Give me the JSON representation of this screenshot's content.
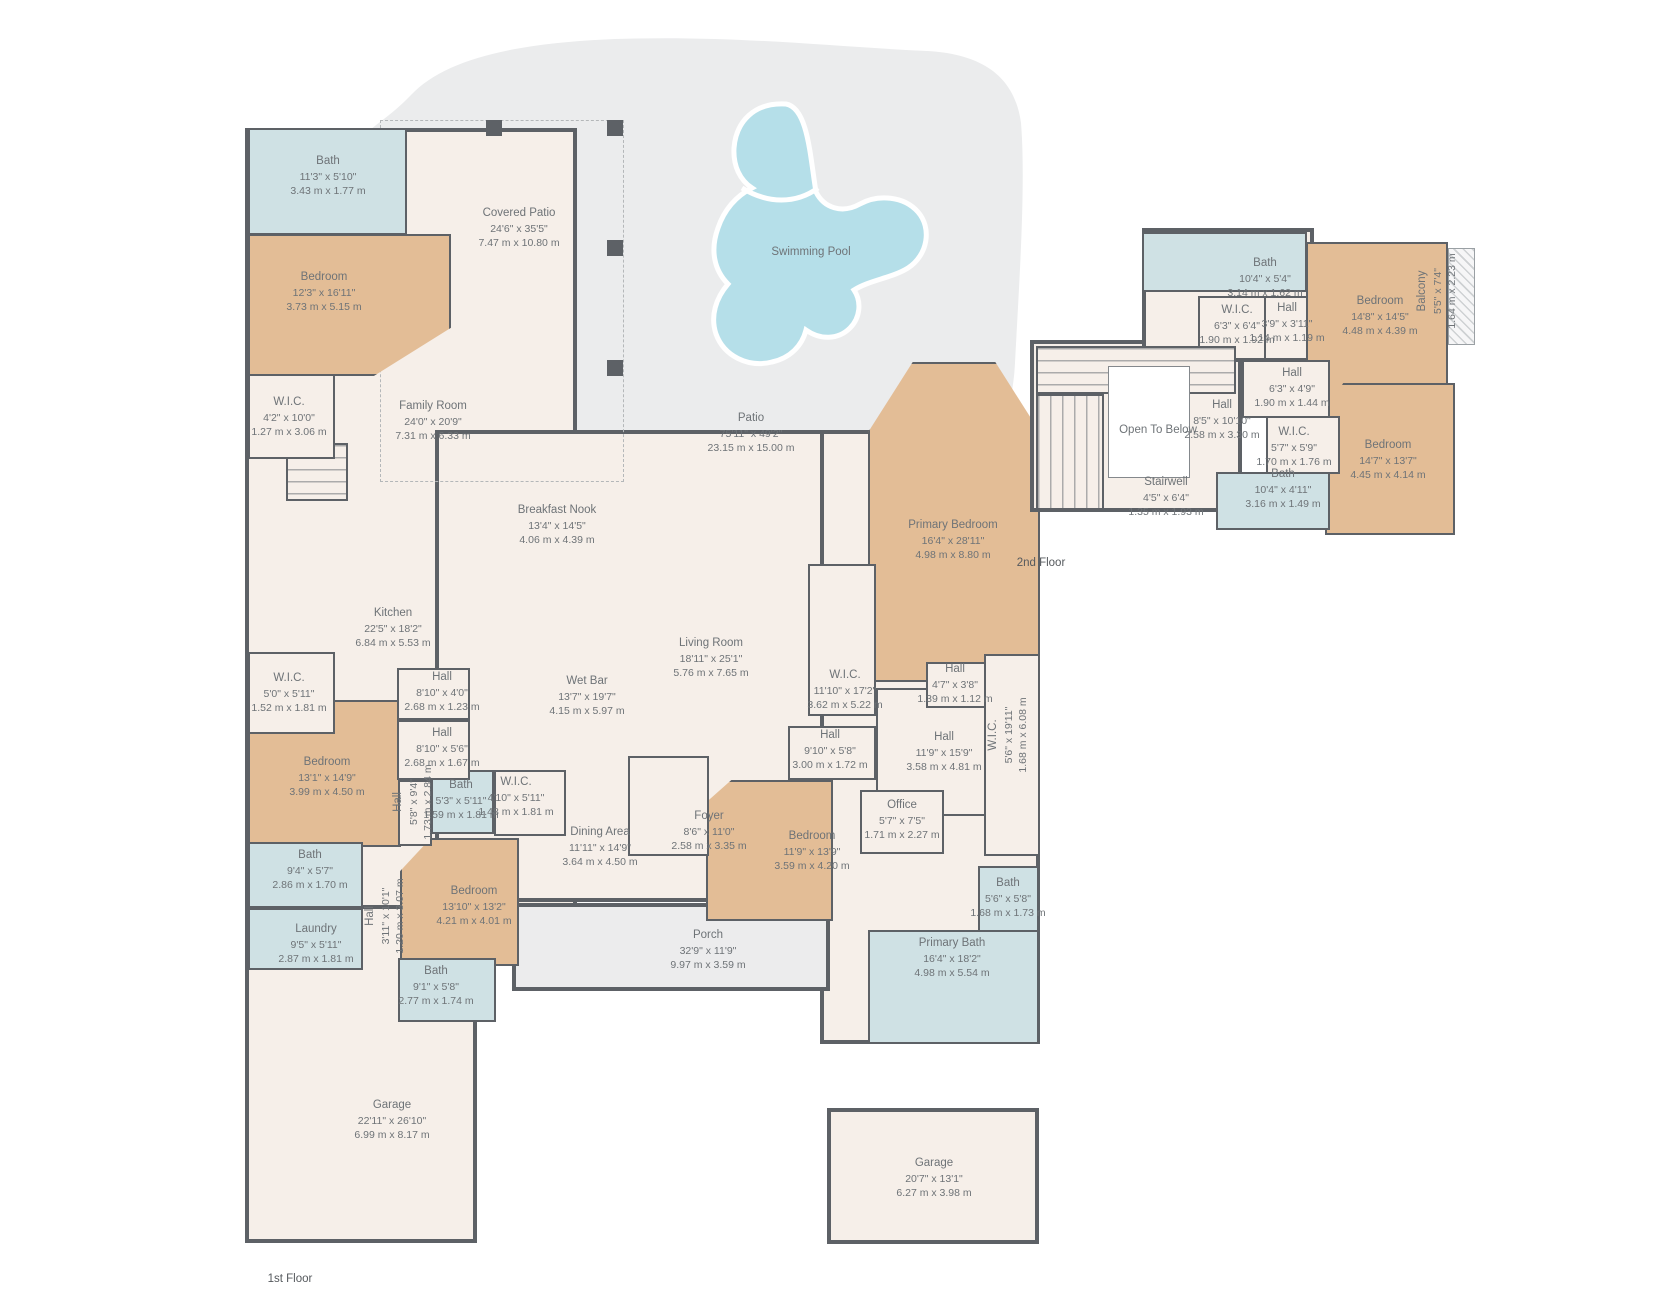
{
  "colors": {
    "wall": "#5d6166",
    "floor": "#f6efe9",
    "bedroom": "#e3bd96",
    "bath": "#cfe1e4",
    "outdoor": "#ebeced",
    "porch": "#ececed",
    "pool": "#b5dfe9",
    "text": "#6e7377",
    "white": "#ffffff"
  },
  "outdoor": {
    "patio_shape": "patio-area",
    "pool_shape": "swimming-pool"
  },
  "floors": [
    {
      "name": "1st Floor",
      "caption_x": 290,
      "caption_y": 1279,
      "blocks": [
        {
          "name": "left-wing",
          "cls": "outer",
          "fill": "floor",
          "x": 245,
          "y": 128,
          "w": 332,
          "h": 812
        },
        {
          "name": "center-wing",
          "cls": "outer",
          "fill": "floor",
          "x": 435,
          "y": 430,
          "w": 392,
          "h": 472
        },
        {
          "name": "right-wing",
          "cls": "outer",
          "fill": "floor",
          "x": 820,
          "y": 430,
          "w": 220,
          "h": 614
        },
        {
          "name": "garage-block",
          "cls": "outer",
          "fill": "floor",
          "x": 245,
          "y": 905,
          "w": 232,
          "h": 338
        },
        {
          "name": "porch",
          "cls": "outer",
          "fill": "porch",
          "x": 512,
          "y": 903,
          "w": 318,
          "h": 88
        },
        {
          "name": "garage-2",
          "cls": "outer",
          "fill": "floor",
          "x": 827,
          "y": 1108,
          "w": 212,
          "h": 136
        },
        {
          "name": "covered-patio-boundary",
          "cls": "dash",
          "x": 380,
          "y": 120,
          "w": 244,
          "h": 362
        },
        {
          "name": "column",
          "cls": "col",
          "fill": "wall",
          "x": 486,
          "y": 120,
          "w": 16,
          "h": 16
        },
        {
          "name": "column",
          "cls": "col",
          "fill": "wall",
          "x": 607,
          "y": 120,
          "w": 16,
          "h": 16
        },
        {
          "name": "column",
          "cls": "col",
          "fill": "wall",
          "x": 607,
          "y": 240,
          "w": 16,
          "h": 16
        },
        {
          "name": "column",
          "cls": "col",
          "fill": "wall",
          "x": 607,
          "y": 360,
          "w": 16,
          "h": 16
        },
        {
          "name": "stairs",
          "cls": "stairs-v",
          "fill": "floor",
          "x": 286,
          "y": 443,
          "w": 62,
          "h": 58
        },
        {
          "name": "bedroom",
          "fill": "bedroom",
          "x": 248,
          "y": 234,
          "w": 203,
          "h": 142,
          "clip": "polygon(0 0,100% 0,100% 66%,62% 100%,0 100%)"
        },
        {
          "name": "bedroom",
          "fill": "bedroom",
          "x": 248,
          "y": 700,
          "w": 153,
          "h": 147
        },
        {
          "name": "bedroom",
          "fill": "bedroom",
          "x": 400,
          "y": 838,
          "w": 119,
          "h": 128,
          "clip": "polygon(26% 0,100% 0,100% 100%,0 100%,0 26%)"
        },
        {
          "name": "bedroom",
          "fill": "bedroom",
          "x": 706,
          "y": 780,
          "w": 127,
          "h": 141,
          "clip": "polygon(20% 0,100% 0,100% 100%,0 100%,0 16%)"
        },
        {
          "name": "primary-bedroom",
          "fill": "bedroom",
          "x": 868,
          "y": 362,
          "w": 172,
          "h": 320,
          "clip": "polygon(0 22%,26% 0,74% 0,100% 22%,100% 100%,0 100%)"
        },
        {
          "name": "bath",
          "fill": "bath",
          "x": 248,
          "y": 128,
          "w": 159,
          "h": 107
        },
        {
          "name": "bath",
          "fill": "bath",
          "x": 431,
          "y": 770,
          "w": 63,
          "h": 64
        },
        {
          "name": "bath",
          "fill": "bath",
          "x": 248,
          "y": 842,
          "w": 115,
          "h": 66
        },
        {
          "name": "laundry",
          "fill": "bath",
          "x": 248,
          "y": 908,
          "w": 115,
          "h": 62
        },
        {
          "name": "bath",
          "fill": "bath",
          "x": 398,
          "y": 958,
          "w": 98,
          "h": 64
        },
        {
          "name": "bath",
          "fill": "bath",
          "x": 978,
          "y": 866,
          "w": 61,
          "h": 66
        },
        {
          "name": "primary-bath",
          "fill": "bath",
          "x": 868,
          "y": 930,
          "w": 171,
          "h": 114
        },
        {
          "name": "wic",
          "fill": "floor",
          "x": 248,
          "y": 374,
          "w": 87,
          "h": 85
        },
        {
          "name": "wic",
          "fill": "floor",
          "x": 248,
          "y": 652,
          "w": 87,
          "h": 82
        },
        {
          "name": "hall",
          "fill": "floor",
          "x": 397,
          "y": 668,
          "w": 73,
          "h": 52
        },
        {
          "name": "hall",
          "fill": "floor",
          "x": 397,
          "y": 720,
          "w": 73,
          "h": 60
        },
        {
          "name": "hall",
          "fill": "floor",
          "x": 398,
          "y": 780,
          "w": 34,
          "h": 66
        },
        {
          "name": "wic",
          "fill": "floor",
          "x": 494,
          "y": 770,
          "w": 72,
          "h": 66
        },
        {
          "name": "foyer",
          "fill": "floor",
          "x": 628,
          "y": 756,
          "w": 81,
          "h": 100
        },
        {
          "name": "hall",
          "fill": "floor",
          "x": 788,
          "y": 726,
          "w": 88,
          "h": 54
        },
        {
          "name": "hall",
          "fill": "floor",
          "x": 876,
          "y": 688,
          "w": 112,
          "h": 128
        },
        {
          "name": "office",
          "fill": "floor",
          "x": 860,
          "y": 790,
          "w": 84,
          "h": 64
        },
        {
          "name": "wic",
          "fill": "floor",
          "x": 808,
          "y": 564,
          "w": 68,
          "h": 152
        },
        {
          "name": "hall",
          "fill": "floor",
          "x": 926,
          "y": 662,
          "w": 60,
          "h": 46
        },
        {
          "name": "wic",
          "fill": "floor",
          "x": 984,
          "y": 654,
          "w": 56,
          "h": 202
        }
      ],
      "labels": [
        {
          "name": "Bath",
          "ft": "11'3\" x 5'10\"",
          "m": "3.43 m x 1.77 m",
          "x": 328,
          "y": 176
        },
        {
          "name": "Bedroom",
          "ft": "12'3\" x 16'11\"",
          "m": "3.73 m x 5.15 m",
          "x": 324,
          "y": 292
        },
        {
          "name": "Covered Patio",
          "ft": "24'6\" x 35'5\"",
          "m": "7.47 m x 10.80 m",
          "x": 519,
          "y": 228
        },
        {
          "name": "Swimming Pool",
          "ft": "",
          "m": "",
          "x": 811,
          "y": 253
        },
        {
          "name": "Patio",
          "ft": "75'11\" x 49'2\"",
          "m": "23.15 m x 15.00 m",
          "x": 751,
          "y": 433
        },
        {
          "name": "W.I.C.",
          "ft": "4'2\" x 10'0\"",
          "m": "1.27 m x 3.06 m",
          "x": 289,
          "y": 417
        },
        {
          "name": "Family Room",
          "ft": "24'0\" x 20'9\"",
          "m": "7.31 m x 6.33 m",
          "x": 433,
          "y": 421
        },
        {
          "name": "Breakfast Nook",
          "ft": "13'4\" x 14'5\"",
          "m": "4.06 m x 4.39 m",
          "x": 557,
          "y": 525
        },
        {
          "name": "Kitchen",
          "ft": "22'5\" x 18'2\"",
          "m": "6.84 m x 5.53 m",
          "x": 393,
          "y": 628
        },
        {
          "name": "Hall",
          "ft": "8'10\" x 4'0\"",
          "m": "2.68 m x 1.23 m",
          "x": 442,
          "y": 692
        },
        {
          "name": "Wet Bar",
          "ft": "13'7\" x 19'7\"",
          "m": "4.15 m x 5.97 m",
          "x": 587,
          "y": 696
        },
        {
          "name": "Living Room",
          "ft": "18'11\" x 25'1\"",
          "m": "5.76 m x 7.65 m",
          "x": 711,
          "y": 658
        },
        {
          "name": "Primary Bedroom",
          "ft": "16'4\" x 28'11\"",
          "m": "4.98 m x 8.80 m",
          "x": 953,
          "y": 540
        },
        {
          "name": "W.I.C.",
          "ft": "11'10\" x 17'2\"",
          "m": "3.62 m x 5.22 m",
          "x": 845,
          "y": 690
        },
        {
          "name": "Hall",
          "ft": "4'7\" x 3'8\"",
          "m": "1.39 m x 1.12 m",
          "x": 955,
          "y": 684
        },
        {
          "name": "W.I.C.",
          "ft": "5'6\" x 19'11\"",
          "m": "1.68 m x 6.08 m",
          "x": 1008,
          "y": 735,
          "rot": true
        },
        {
          "name": "W.I.C.",
          "ft": "5'0\" x 5'11\"",
          "m": "1.52 m x 1.81 m",
          "x": 289,
          "y": 693
        },
        {
          "name": "Bedroom",
          "ft": "13'1\" x 14'9\"",
          "m": "3.99 m x 4.50 m",
          "x": 327,
          "y": 777
        },
        {
          "name": "Hall",
          "ft": "8'10\" x 5'6\"",
          "m": "2.68 m x 1.67 m",
          "x": 442,
          "y": 748
        },
        {
          "name": "Hall",
          "ft": "5'8\" x 9'4\"",
          "m": "1.73 m x 2.84 m",
          "x": 413,
          "y": 802,
          "rot": true
        },
        {
          "name": "Bath",
          "ft": "5'3\" x 5'11\"",
          "m": "1.59 m x 1.81 m",
          "x": 461,
          "y": 800
        },
        {
          "name": "W.I.C.",
          "ft": "4'10\" x 5'11\"",
          "m": "1.48 m x 1.81 m",
          "x": 516,
          "y": 797
        },
        {
          "name": "Hall",
          "ft": "9'10\" x 5'8\"",
          "m": "3.00 m x 1.72 m",
          "x": 830,
          "y": 750
        },
        {
          "name": "Hall",
          "ft": "11'9\" x 15'9\"",
          "m": "3.58 m x 4.81 m",
          "x": 944,
          "y": 752
        },
        {
          "name": "Bath",
          "ft": "9'4\" x 5'7\"",
          "m": "2.86 m x 1.70 m",
          "x": 310,
          "y": 870
        },
        {
          "name": "Laundry",
          "ft": "9'5\" x 5'11\"",
          "m": "2.87 m x 1.81 m",
          "x": 316,
          "y": 944
        },
        {
          "name": "Hall",
          "ft": "3'11\" x 10'1\"",
          "m": "1.20 m x 3.07 m",
          "x": 385,
          "y": 916,
          "rot": true
        },
        {
          "name": "Bedroom",
          "ft": "13'10\" x 13'2\"",
          "m": "4.21 m x 4.01 m",
          "x": 474,
          "y": 906
        },
        {
          "name": "Dining Area",
          "ft": "11'11\" x 14'9\"",
          "m": "3.64 m x 4.50 m",
          "x": 600,
          "y": 847
        },
        {
          "name": "Foyer",
          "ft": "8'6\" x 11'0\"",
          "m": "2.58 m x 3.35 m",
          "x": 709,
          "y": 831
        },
        {
          "name": "Bedroom",
          "ft": "11'9\" x 13'9\"",
          "m": "3.59 m x 4.20 m",
          "x": 812,
          "y": 851
        },
        {
          "name": "Office",
          "ft": "5'7\" x 7'5\"",
          "m": "1.71 m x 2.27 m",
          "x": 902,
          "y": 820
        },
        {
          "name": "Bath",
          "ft": "5'6\" x 5'8\"",
          "m": "1.68 m x 1.73 m",
          "x": 1008,
          "y": 898
        },
        {
          "name": "Primary Bath",
          "ft": "16'4\" x 18'2\"",
          "m": "4.98 m x 5.54 m",
          "x": 952,
          "y": 958
        },
        {
          "name": "Bath",
          "ft": "9'1\" x 5'8\"",
          "m": "2.77 m x 1.74 m",
          "x": 436,
          "y": 986
        },
        {
          "name": "Porch",
          "ft": "32'9\" x 11'9\"",
          "m": "9.97 m x 3.59 m",
          "x": 708,
          "y": 950
        },
        {
          "name": "Garage",
          "ft": "22'11\" x 26'10\"",
          "m": "6.99 m x 8.17 m",
          "x": 392,
          "y": 1120
        },
        {
          "name": "Garage",
          "ft": "20'7\" x 13'1\"",
          "m": "6.27 m x 3.98 m",
          "x": 934,
          "y": 1178
        }
      ]
    },
    {
      "name": "2nd Floor",
      "caption_x": 1041,
      "caption_y": 563,
      "blocks": [
        {
          "name": "upper-left-wing",
          "cls": "outer",
          "fill": "floor",
          "x": 1030,
          "y": 340,
          "w": 212,
          "h": 172
        },
        {
          "name": "upper-top-wing",
          "cls": "outer",
          "fill": "floor",
          "x": 1142,
          "y": 228,
          "w": 172,
          "h": 134
        },
        {
          "name": "bath",
          "fill": "bath",
          "x": 1142,
          "y": 232,
          "w": 165,
          "h": 60
        },
        {
          "name": "wic",
          "fill": "floor",
          "x": 1198,
          "y": 296,
          "w": 68,
          "h": 64
        },
        {
          "name": "hall",
          "fill": "floor",
          "x": 1264,
          "y": 296,
          "w": 49,
          "h": 64
        },
        {
          "name": "bedroom",
          "fill": "bedroom",
          "x": 1306,
          "y": 242,
          "w": 142,
          "h": 202,
          "clip": "polygon(0 0,100% 0,100% 100%,20% 100%,0 80%)"
        },
        {
          "name": "bedroom",
          "fill": "bedroom",
          "x": 1325,
          "y": 383,
          "w": 130,
          "h": 152,
          "clip": "polygon(14% 0,100% 0,100% 100%,0 100%,0 20%)"
        },
        {
          "name": "hall",
          "fill": "floor",
          "x": 1242,
          "y": 360,
          "w": 88,
          "h": 58
        },
        {
          "name": "wic",
          "fill": "floor",
          "x": 1266,
          "y": 416,
          "w": 74,
          "h": 58
        },
        {
          "name": "bath",
          "fill": "bath",
          "x": 1216,
          "y": 472,
          "w": 114,
          "h": 58
        },
        {
          "name": "stairs",
          "cls": "stairs-v",
          "fill": "floor",
          "x": 1036,
          "y": 346,
          "w": 200,
          "h": 48
        },
        {
          "name": "stairs",
          "cls": "stairs-h",
          "fill": "floor",
          "x": 1036,
          "y": 394,
          "w": 68,
          "h": 116
        },
        {
          "name": "open-to-below-void",
          "cls": "void",
          "fill": "white",
          "x": 1108,
          "y": 366,
          "w": 82,
          "h": 112
        },
        {
          "name": "balcony",
          "cls": "hatch",
          "x": 1448,
          "y": 248,
          "w": 27,
          "h": 97
        }
      ],
      "labels": [
        {
          "name": "Bath",
          "ft": "10'4\" x 5'4\"",
          "m": "3.14 m x 1.62 m",
          "x": 1265,
          "y": 278
        },
        {
          "name": "W.I.C.",
          "ft": "6'3\" x 6'4\"",
          "m": "1.90 m x 1.92 m",
          "x": 1237,
          "y": 325
        },
        {
          "name": "Hall",
          "ft": "3'9\" x 3'11\"",
          "m": "1.14 m x 1.19 m",
          "x": 1287,
          "y": 323
        },
        {
          "name": "Bedroom",
          "ft": "14'8\" x 14'5\"",
          "m": "4.48 m x 4.39 m",
          "x": 1380,
          "y": 316
        },
        {
          "name": "Balcony",
          "ft": "5'5\" x 7'4\"",
          "m": "1.64 m x 2.23 m",
          "x": 1437,
          "y": 291,
          "rot": true
        },
        {
          "name": "Hall",
          "ft": "6'3\" x 4'9\"",
          "m": "1.90 m x 1.44 m",
          "x": 1292,
          "y": 388
        },
        {
          "name": "Hall",
          "ft": "8'5\" x 10'10\"",
          "m": "2.58 m x 3.30 m",
          "x": 1222,
          "y": 420
        },
        {
          "name": "Open To Below",
          "ft": "",
          "m": "",
          "x": 1158,
          "y": 431
        },
        {
          "name": "W.I.C.",
          "ft": "5'7\" x 5'9\"",
          "m": "1.70 m x 1.76 m",
          "x": 1294,
          "y": 447
        },
        {
          "name": "Bedroom",
          "ft": "14'7\" x 13'7\"",
          "m": "4.45 m x 4.14 m",
          "x": 1388,
          "y": 460
        },
        {
          "name": "Stairwell",
          "ft": "4'5\" x 6'4\"",
          "m": "1.35 m x 1.93 m",
          "x": 1166,
          "y": 497
        },
        {
          "name": "Bath",
          "ft": "10'4\" x 4'11\"",
          "m": "3.16 m x 1.49 m",
          "x": 1283,
          "y": 489
        }
      ]
    }
  ]
}
